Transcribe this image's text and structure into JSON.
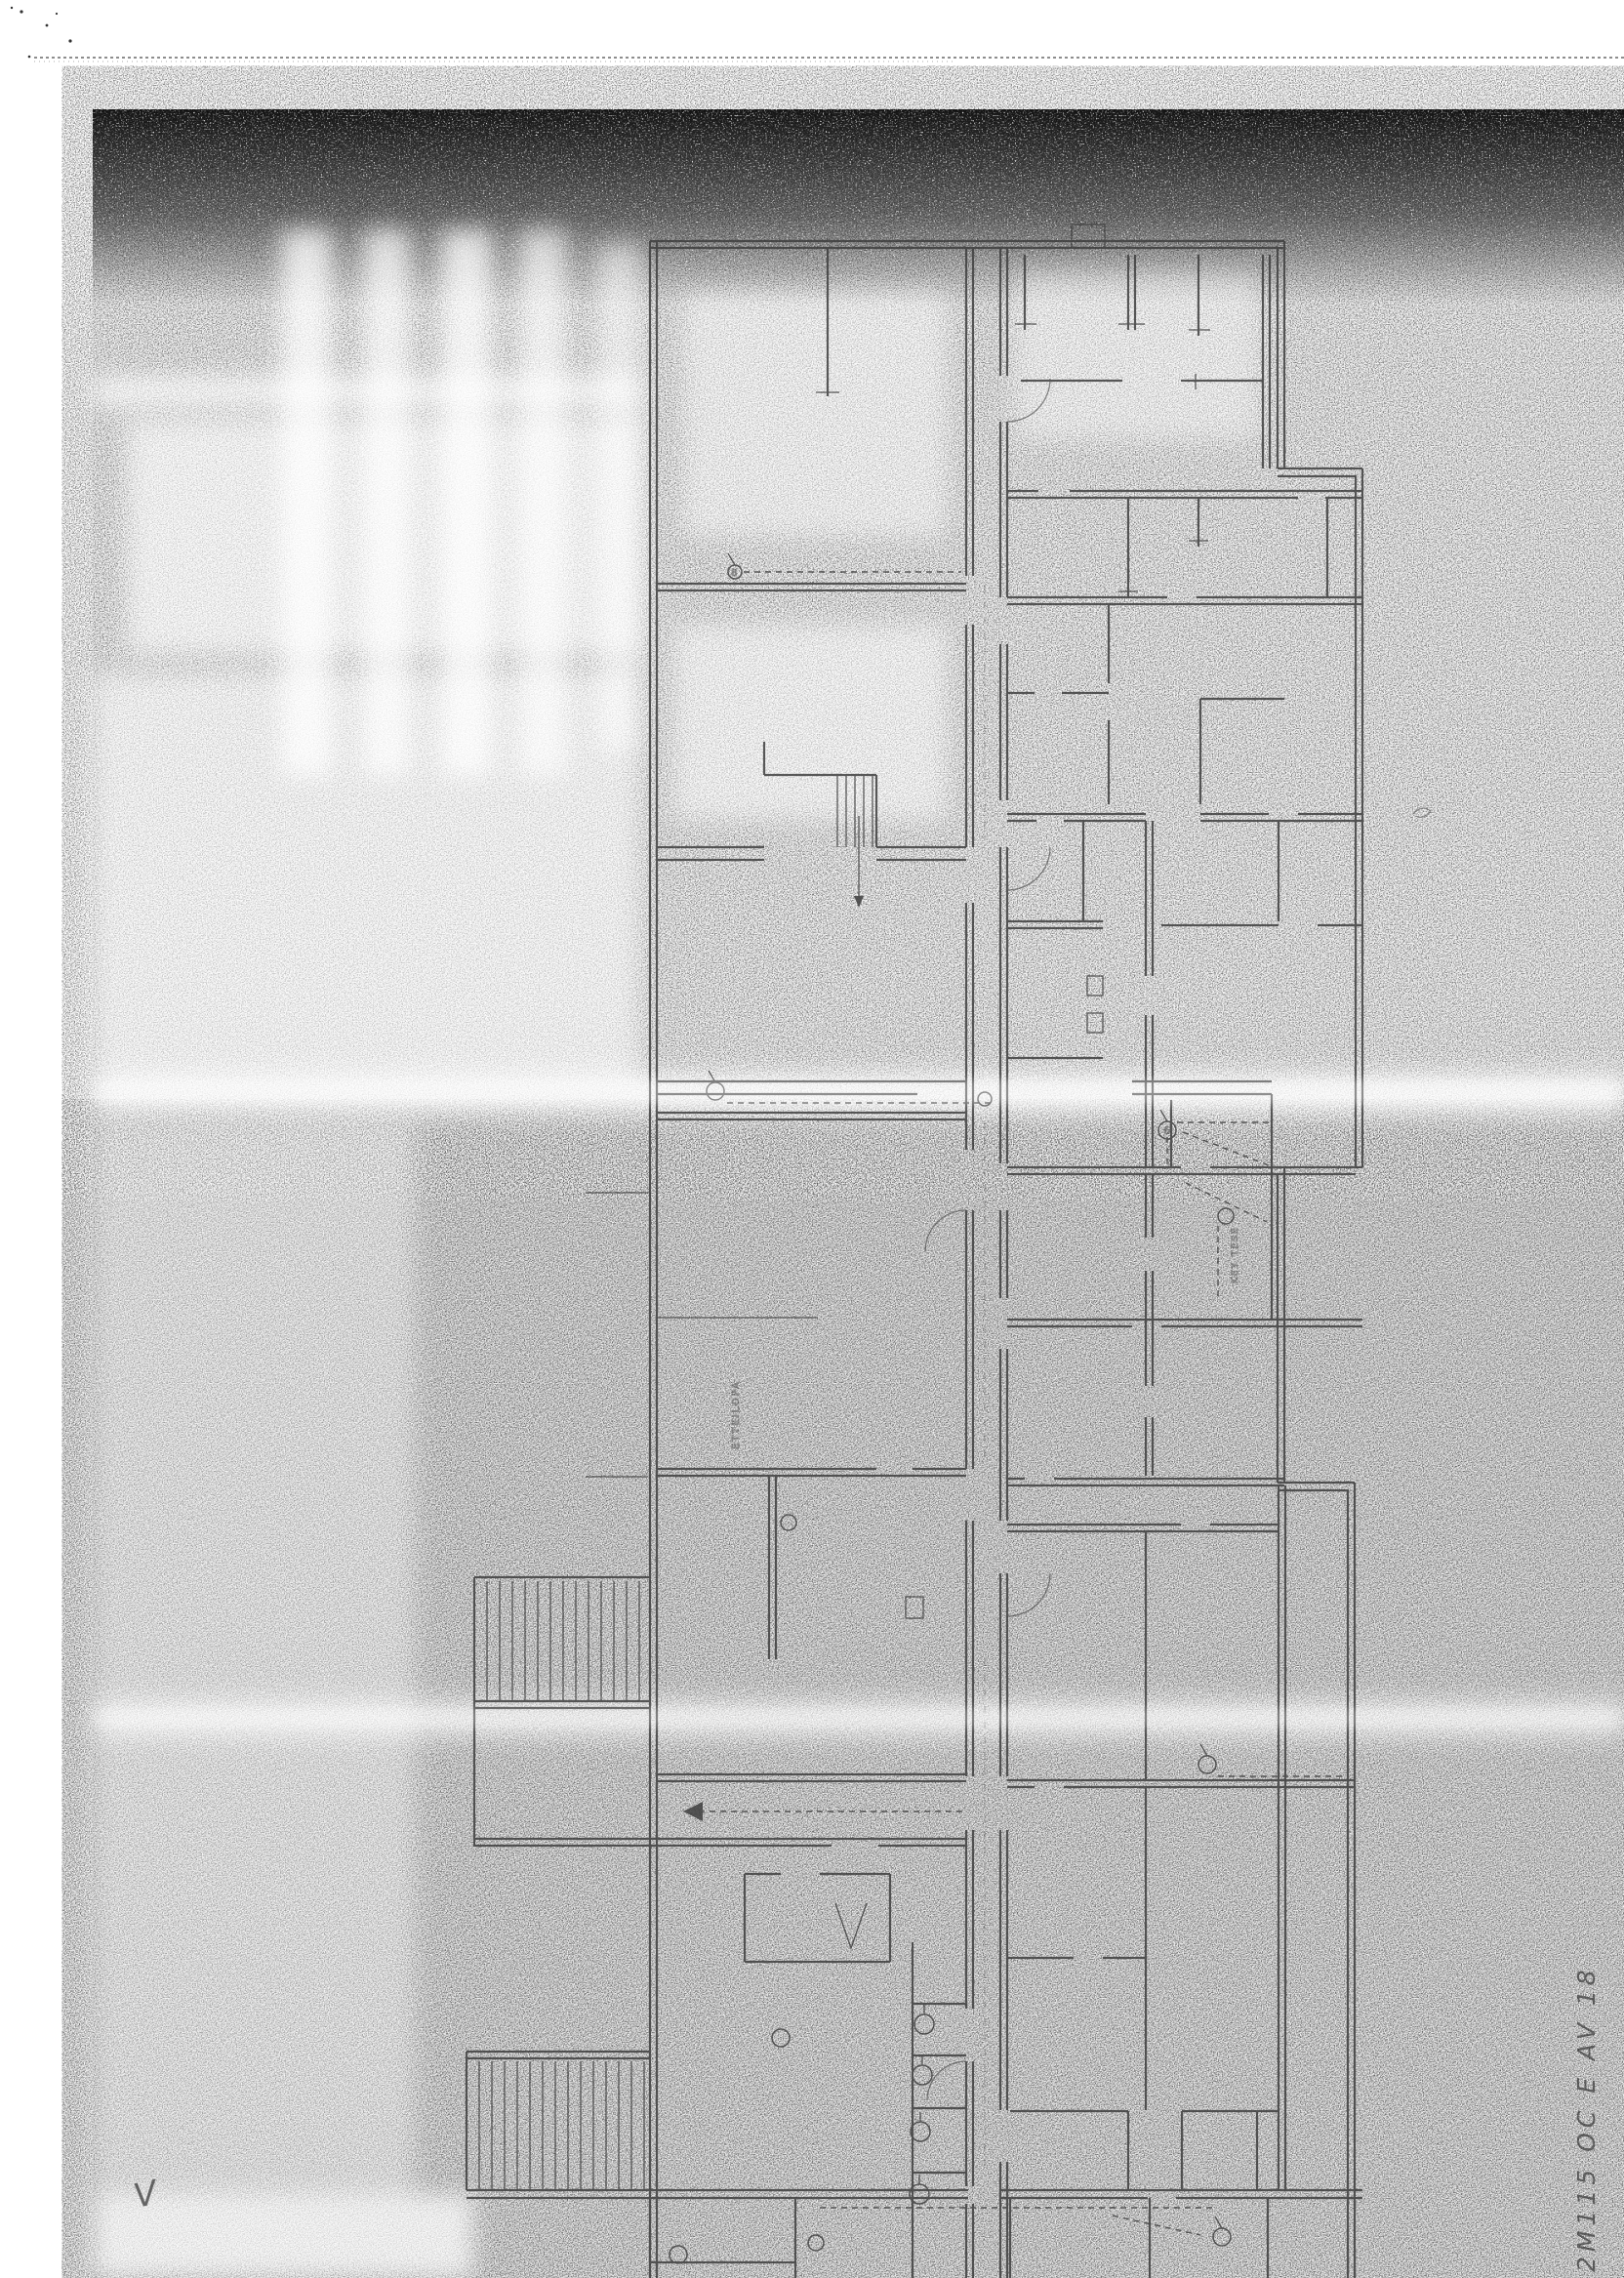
{
  "document": {
    "handwritten_note": "2M115 OC E AV 18",
    "corner_mark": "V",
    "plan_labels": {
      "room_label": "ETTEILOPA",
      "area_label": "KEY TESE",
      "symbol_tag_a": "6",
      "symbol_tag_b": "8"
    },
    "colors": {
      "paper": "#ffffff",
      "ink": "#3c3c3c",
      "grain": "#161616"
    }
  }
}
